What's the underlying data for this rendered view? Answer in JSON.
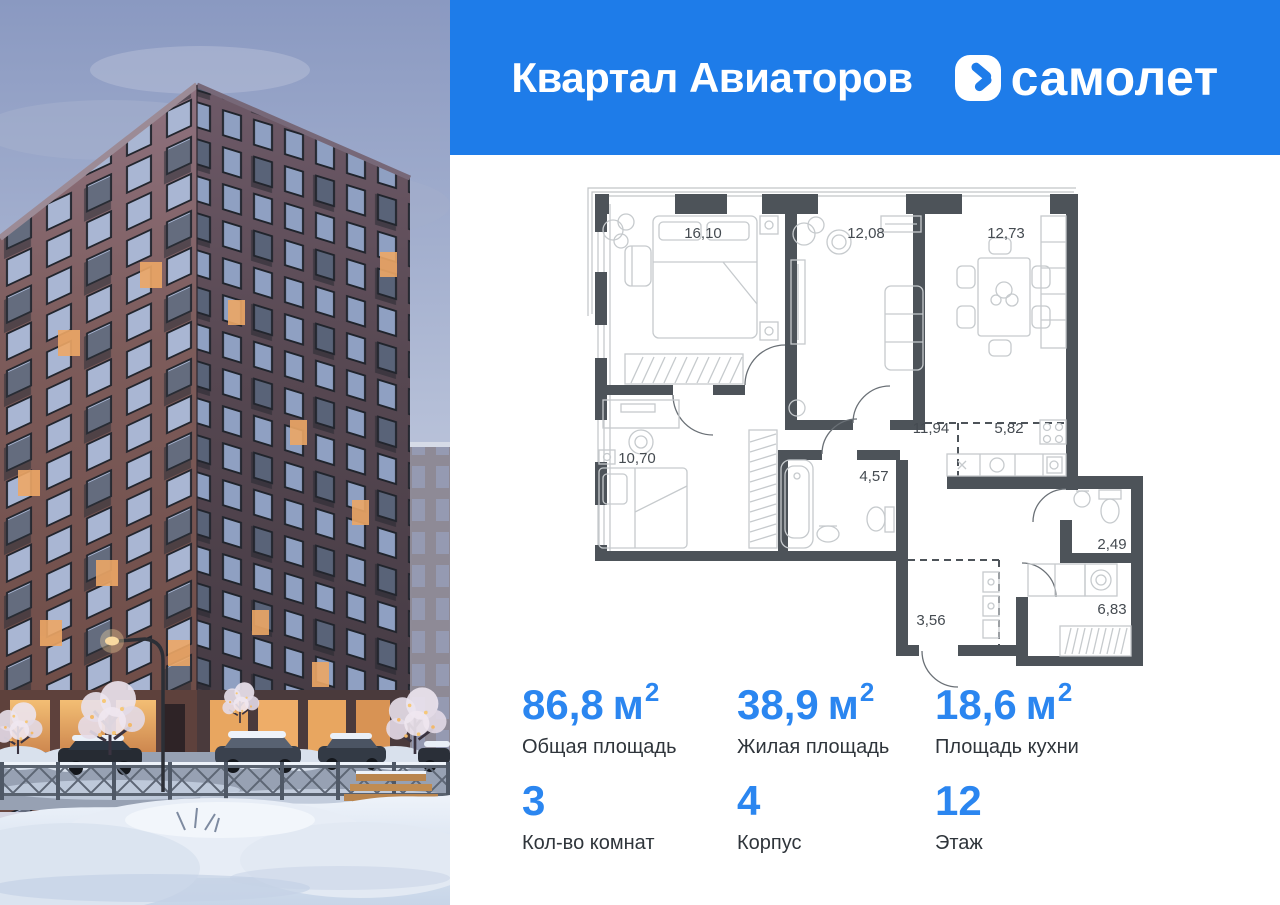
{
  "header": {
    "project_name": "Квартал Авиаторов",
    "brand": "самолет",
    "bg_color": "#1e7ce9"
  },
  "floor_plan": {
    "rooms": [
      {
        "area": "16,10"
      },
      {
        "area": "12,08"
      },
      {
        "area": "12,73"
      },
      {
        "area": "11,94"
      },
      {
        "area": "5,82"
      },
      {
        "area": "10,70"
      },
      {
        "area": "4,57"
      },
      {
        "area": "3,56"
      },
      {
        "area": "2,49"
      },
      {
        "area": "6,83"
      }
    ]
  },
  "stats": {
    "accent_color": "#2b86f0",
    "items": [
      {
        "value": "86,8",
        "unit": "м",
        "unit_sup": "2",
        "label": "Общая площадь"
      },
      {
        "value": "38,9",
        "unit": "м",
        "unit_sup": "2",
        "label": "Жилая площадь"
      },
      {
        "value": "18,6",
        "unit": "м",
        "unit_sup": "2",
        "label": "Площадь кухни"
      },
      {
        "value": "3",
        "label": "Кол-во комнат"
      },
      {
        "value": "4",
        "label": "Корпус"
      },
      {
        "value": "12",
        "label": "Этаж"
      }
    ]
  }
}
